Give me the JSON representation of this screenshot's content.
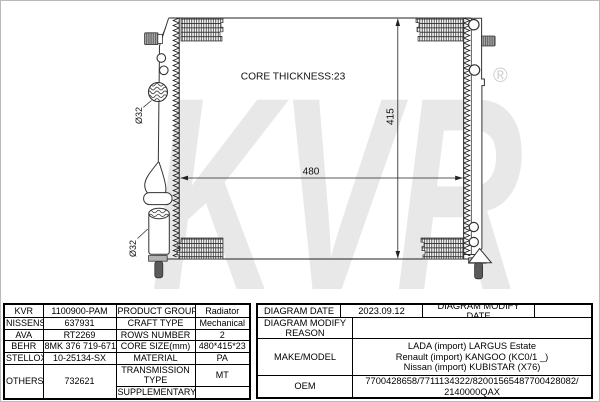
{
  "watermark": {
    "text": "KVR",
    "reg": "®"
  },
  "diagram": {
    "core_thickness": "CORE THICKNESS:23",
    "dim_width": "480",
    "dim_height": "415",
    "port_top": "Ø32",
    "port_bottom": "Ø32"
  },
  "spec_table": {
    "rows": [
      {
        "brand": "KVR",
        "code": "1100900-PAM",
        "property": "PRODUCT GROUP",
        "value": "Radiator"
      },
      {
        "brand": "NISSENS",
        "code": "637931",
        "property": "CRAFT TYPE",
        "value": "Mechanical"
      },
      {
        "brand": "AVA",
        "code": "RT2269",
        "property": "ROWS NUMBER",
        "value": "2"
      },
      {
        "brand": "BEHR",
        "code": "8MK 376 719-671",
        "property": "CORE SIZE(mm)",
        "value": "480*415*23"
      },
      {
        "brand": "STELLOX",
        "code": "10-25134-SX",
        "property": "MATERIAL",
        "value": "PA"
      },
      {
        "brand": "OTHERS",
        "code": "732621",
        "property": "TRANSMISSION TYPE",
        "value": "MT"
      },
      {
        "property": "SUPPLEMENTARY",
        "value": ""
      }
    ]
  },
  "info_table": {
    "diagram_date_label": "DIAGRAM DATE",
    "diagram_date": "2023.09.12",
    "modify_date_label": "DIAGRAM MODIFY DATE",
    "modify_date": "",
    "modify_reason_label": "DIAGRAM MODIFY REASON",
    "modify_reason": "",
    "make_model_label": "MAKE/MODEL",
    "make_model_lines": [
      "LADA (import) LARGUS Estate",
      "Renault (import) KANGOO (KC0/1 _)",
      "Nissan (import) KUBISTAR (X76)"
    ],
    "oem_label": "OEM",
    "oem_lines": [
      "7700428658/7711134322/82001565487700428082/",
      "2140000QAX"
    ]
  }
}
